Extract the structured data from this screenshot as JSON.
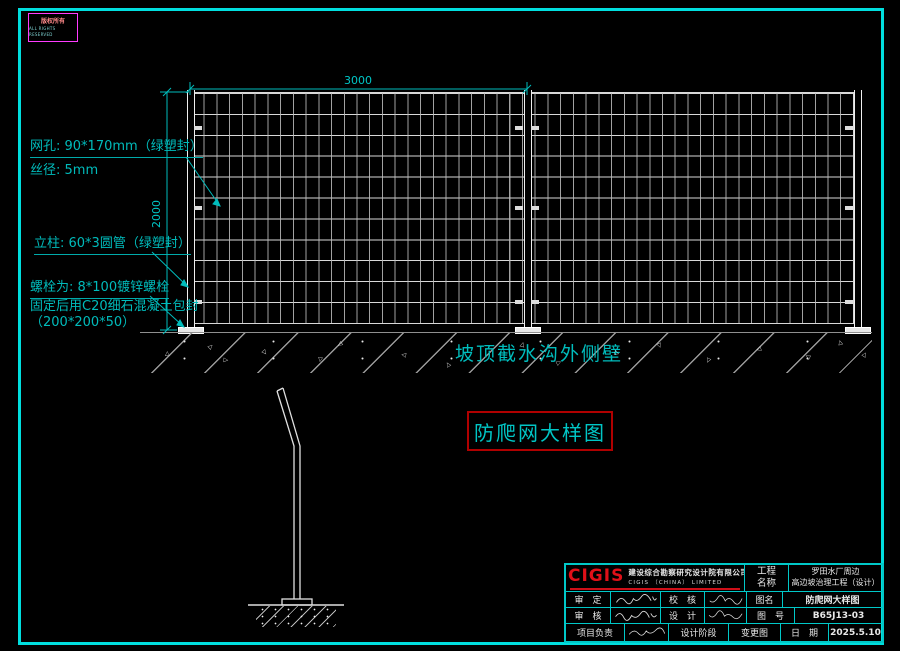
{
  "stamp": {
    "line1": "版权所有",
    "line2": "ALL RIGHTS RESERVED"
  },
  "dimensions": {
    "panel_width": "3000",
    "panel_height": "2000"
  },
  "annotations": {
    "mesh": "网孔: 90*170mm（绿塑封）",
    "wire": "丝径: 5mm",
    "post": "立柱: 60*3圆管（绿塑封）",
    "bolt_line1": "螺栓为: 8*100镀锌螺栓",
    "bolt_line2": "固定后用C20细石混凝土包封",
    "bolt_line3": "（200*200*50）"
  },
  "ground_label": "坡顶截水沟外侧壁",
  "drawing_title": "防爬网大样图",
  "title_block": {
    "logo_text": "CIGIS",
    "company_cn": "建设综合勘察研究设计院有限公司",
    "company_en": "CIGIS （CHINA） LIMITED",
    "project_label_l1": "工程",
    "project_label_l2": "名称",
    "project_name_l1": "罗田水厂周边",
    "project_name_l2": "高边坡治理工程（设计）",
    "fields": {
      "shen_ding": "审　定",
      "xiao_he": "校　核",
      "shen_he": "审　核",
      "she_ji": "设　计",
      "xiang_mu_fu_ze": "项目负责",
      "she_ji_jie_duan": "设计阶段",
      "bian_geng_tu": "变更图",
      "tu_ming_label": "图名",
      "tu_ming": "防爬网大样图",
      "tu_hao_label": "图　号",
      "tu_hao": "B65J13-03",
      "ri_qi_label": "日　期",
      "ri_qi": "2025.5.10"
    }
  },
  "colors": {
    "border_cyan": "#00dede",
    "annotation_cyan": "#00bbbb",
    "logo_red": "#e01018",
    "title_box_red": "#b00000",
    "stamp_magenta": "#ff3bff",
    "mesh_white": "#d8d8d8"
  }
}
